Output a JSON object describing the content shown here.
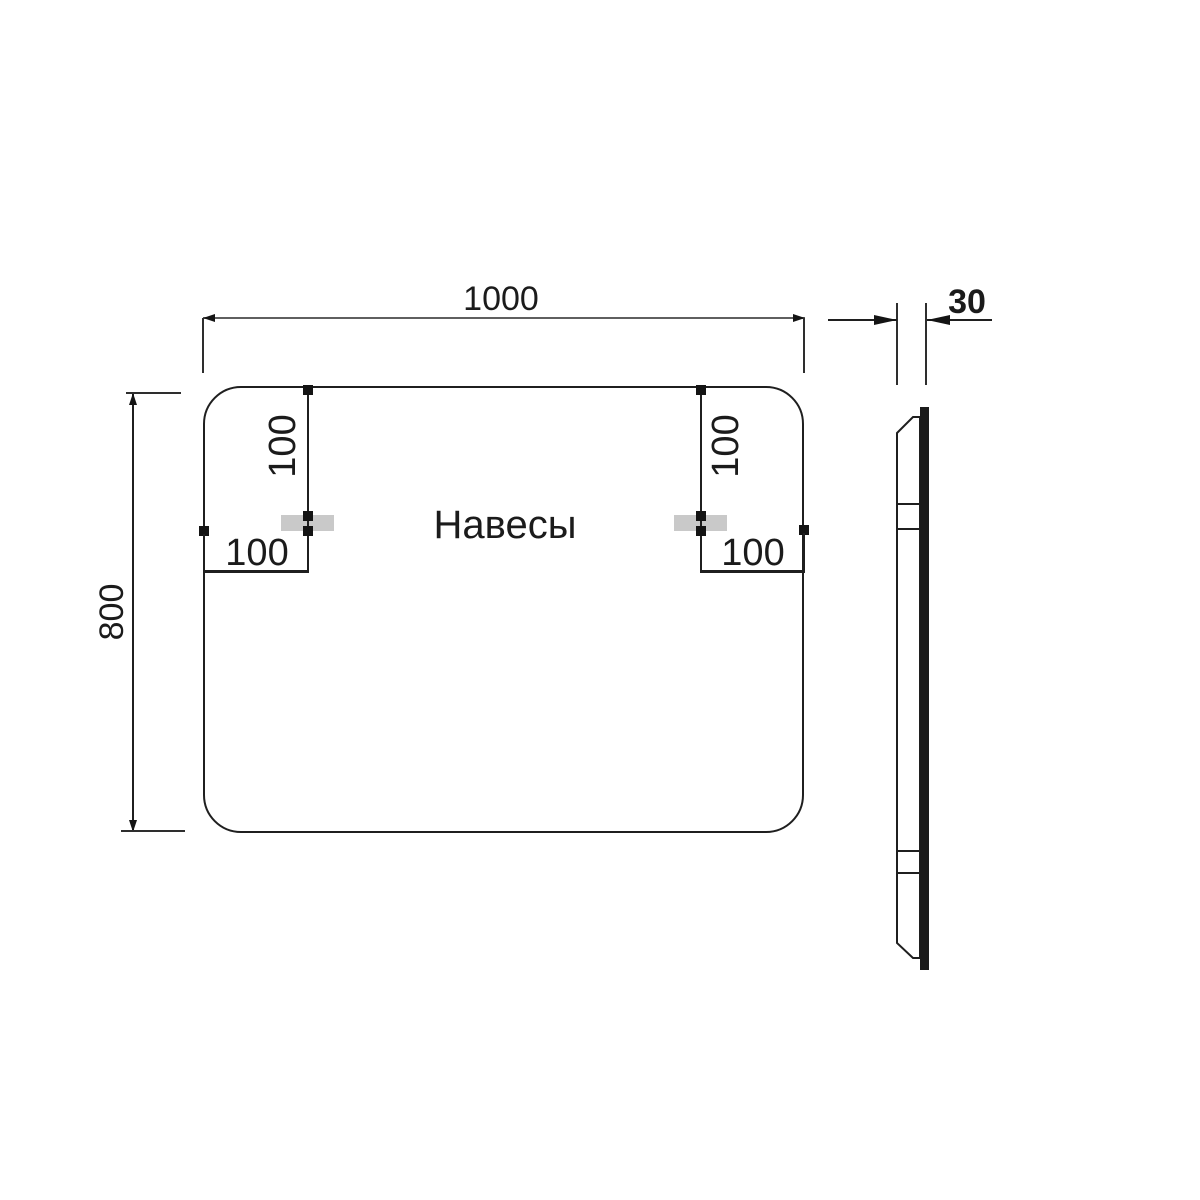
{
  "front_view": {
    "width_label": "1000",
    "height_label": "800",
    "center_label": "Навесы",
    "left_bracket": {
      "top_offset_label": "100",
      "side_offset_label": "100"
    },
    "right_bracket": {
      "top_offset_label": "100",
      "side_offset_label": "100"
    }
  },
  "side_view": {
    "thickness_label": "30"
  },
  "dimensions_mm": {
    "width": 1000,
    "height": 800,
    "depth": 30,
    "bracket_top_offset": 100,
    "bracket_side_offset": 100
  },
  "colors": {
    "line": "#1f1f1f",
    "dimension_gray": "#5f5f5f",
    "bracket_fill": "#c9c9c9",
    "background": "#ffffff"
  }
}
